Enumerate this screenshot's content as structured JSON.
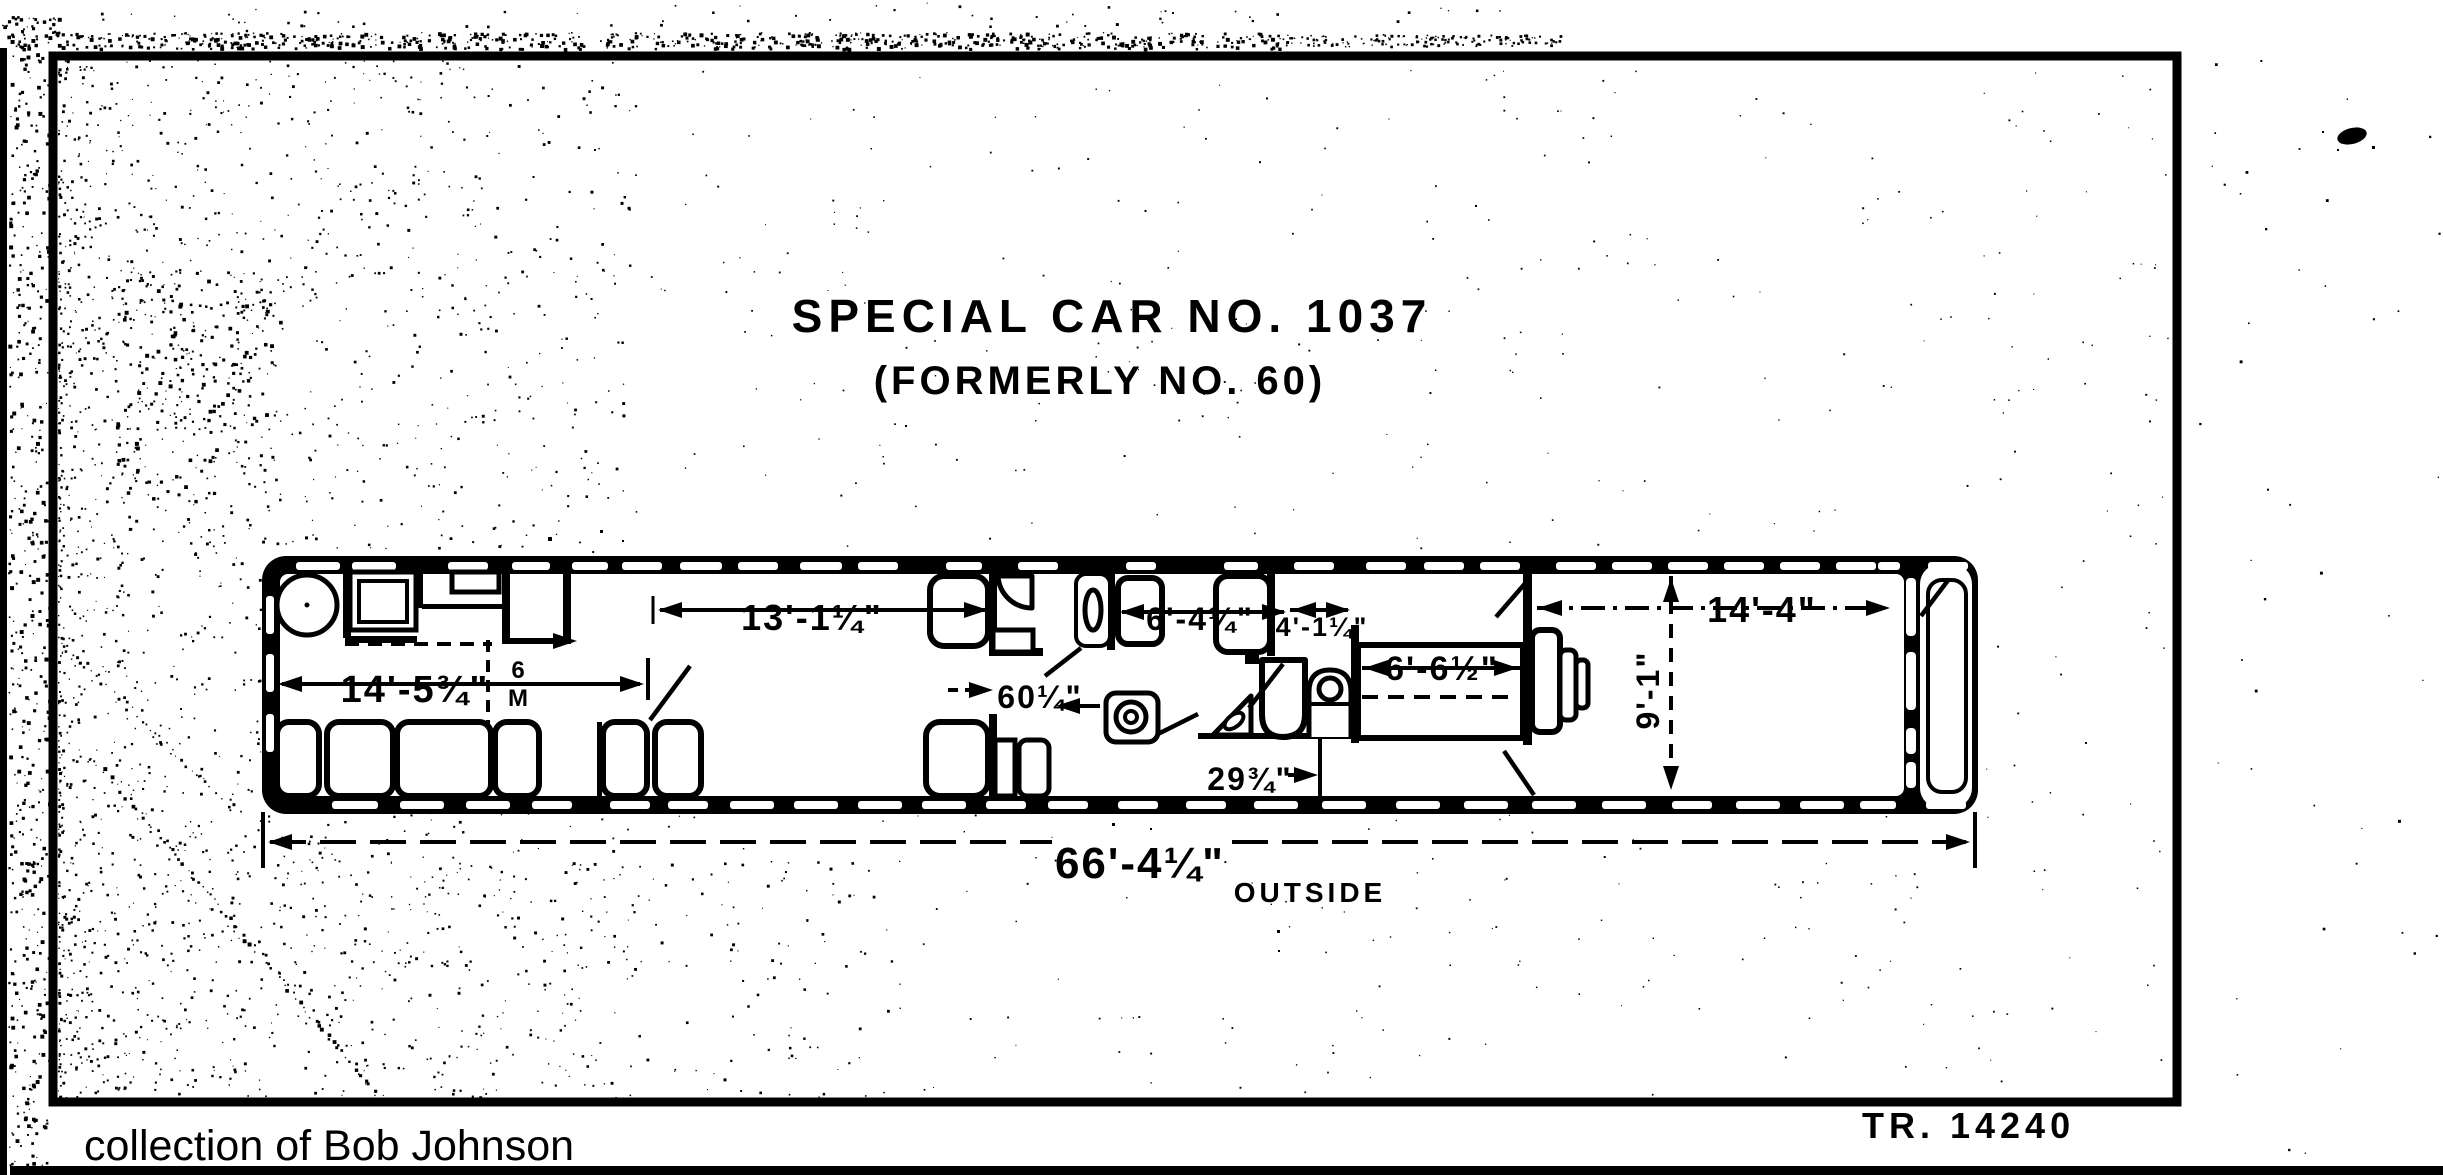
{
  "document": {
    "title": "SPECIAL CAR NO. 1037",
    "subtitle": "(FORMERLY NO. 60)",
    "drawing_number": "TR. 14240",
    "credit": "collection of Bob Johnson"
  },
  "dimensions": {
    "dining_room_length": "14'-5¾\"",
    "lounge_length": "13'-1¼\"",
    "passage_width": "60¼\"",
    "stateroom_length": "6'-4¼\"",
    "toilet_room_length": "4'-1¼\"",
    "observation_room_length": "14'-4\"",
    "car_inside_width": "9'-1\"",
    "bed_length": "6'-6½\"",
    "bed_offset": "29¾\"",
    "overall_length": "66'-4¼\"",
    "overall_length_suffix": "OUTSIDE",
    "small_note_top": "6",
    "small_note_bottom": "M"
  },
  "colors": {
    "ink": "#000000",
    "paper": "#ffffff"
  }
}
